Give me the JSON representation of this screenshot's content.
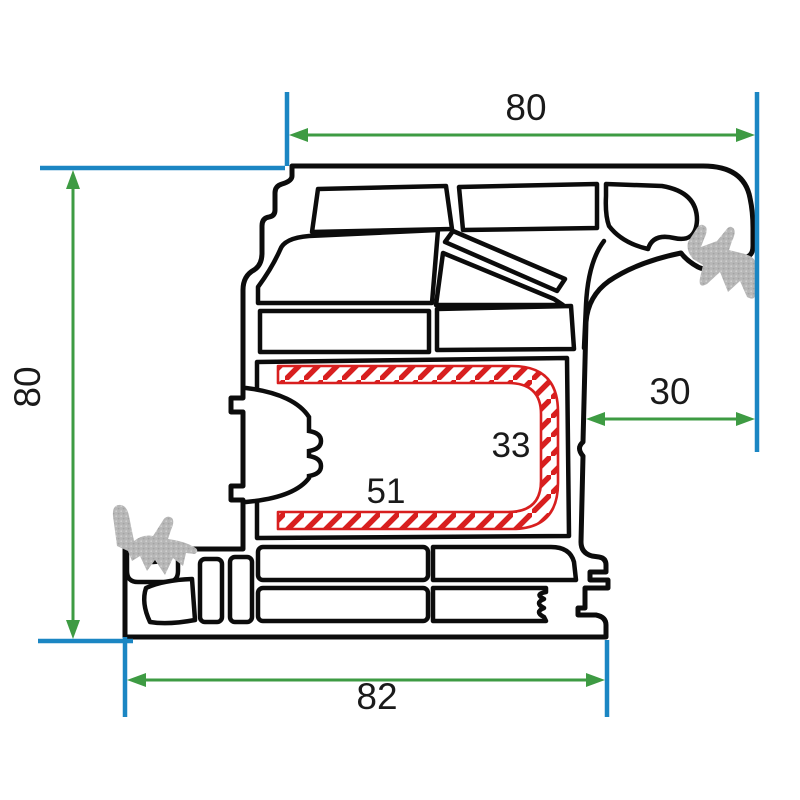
{
  "diagram": {
    "kind": "window-profile-cross-section",
    "dimensions": {
      "top_width": "80",
      "left_height": "80",
      "right_depth": "30",
      "bottom_width": "82",
      "steel_height": "33",
      "steel_width": "51"
    },
    "colors": {
      "profile_outline": "#0c0c0c",
      "extension_line_blue": "#1b86c3",
      "arrow_green": "#3e9b43",
      "steel_hatch_red": "#d81f1f",
      "gasket_gray": "#b7b7b7",
      "background": "#ffffff"
    }
  }
}
